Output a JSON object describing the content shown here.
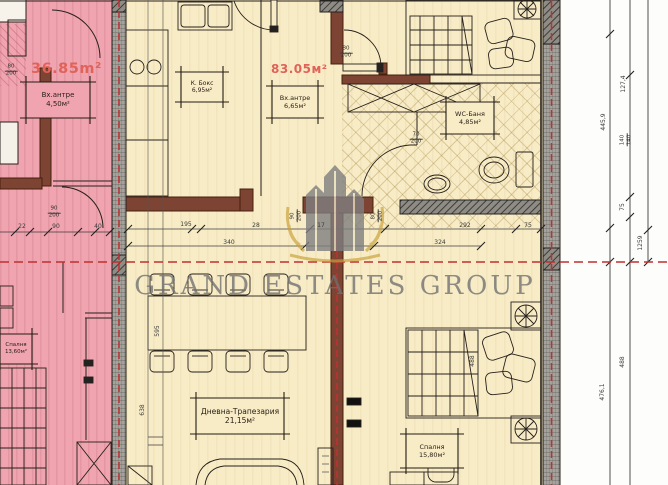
{
  "watermark": {
    "title": "GRAND ESTATES GROUP"
  },
  "units": {
    "left": {
      "area_label": "36.85m²",
      "entry_name": "Вх.антре",
      "entry_area": "4,50м²",
      "bedroom_name": "Спалня",
      "bedroom_area": "13,60м²"
    },
    "main": {
      "area_label": "83.05м²",
      "entry_name": "Вх.антре",
      "entry_area": "6,65м²",
      "kitchen_name": "К. Бокс",
      "kitchen_area": "6,95м²",
      "bath_name": "WC-Баня",
      "bath_area": "4,85м²",
      "living_name": "Дневна-Трапезария",
      "living_area": "21,15м²",
      "bedroom_name": "Спалня",
      "bedroom_area": "15,80м²"
    }
  },
  "doors": {
    "top_center": {
      "w": "80",
      "h": "200"
    },
    "left_top": {
      "w": "80",
      "h": "200"
    },
    "left_mid": {
      "w": "90",
      "h": "200"
    },
    "hall_a": {
      "w": "90",
      "h": "200"
    },
    "hall_b": {
      "w": "80",
      "h": "200"
    },
    "wc": {
      "w": "70",
      "h": "200"
    }
  },
  "dims": {
    "a195": "195",
    "a28": "28",
    "a17": "17",
    "a292": "292",
    "a324": "324",
    "a340": "340",
    "a75": "75",
    "b22": "22",
    "b90": "90",
    "b40": "40",
    "v595": "595",
    "v638": "638",
    "v488": "488",
    "r445": "445,9",
    "r127": "127,4",
    "r140": {
      "w": "140",
      "h": "140"
    },
    "r75": "75",
    "r1259": "1259",
    "r488": "488",
    "r476": "476,1"
  },
  "colors": {
    "floor_beige": "#f8ecc6",
    "floor_pink": "#f0a4af",
    "wall_brown": "#7d4434",
    "boundary_red": "#c03030",
    "area_label_red": "#e0635a"
  }
}
